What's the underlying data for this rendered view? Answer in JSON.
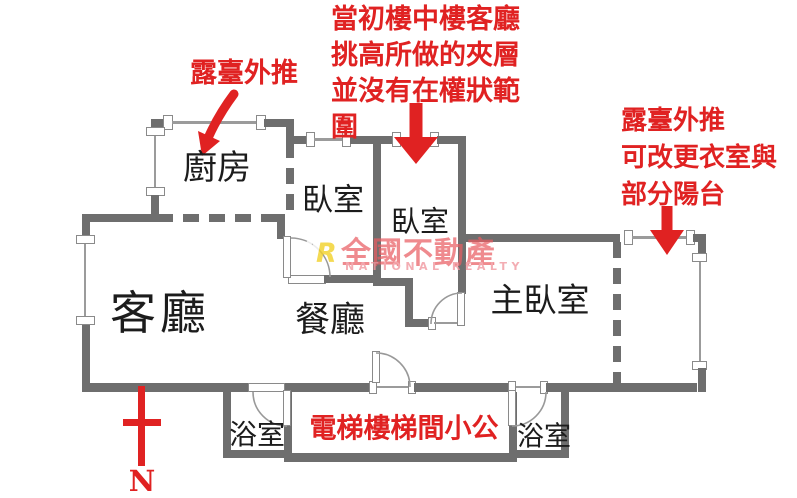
{
  "floorplan": {
    "rooms": {
      "kitchen": "廚房",
      "bedroom1": "臥室",
      "bedroom2": "臥室",
      "living": "客廳",
      "dining": "餐廳",
      "master": "主臥室",
      "bath_left": "浴室",
      "bath_right": "浴室"
    },
    "common_area_label": "電梯樓梯間小公",
    "compass_letter": "N"
  },
  "annotations": {
    "terrace_left": "露臺外推",
    "mezzanine_lines": [
      "當初樓中樓客廳",
      "挑高所做的夾層",
      "並沒有在權狀範",
      "圍"
    ],
    "terrace_right_lines": [
      "露臺外推",
      "可改更衣室與",
      "部分陽台"
    ]
  },
  "watermark": {
    "brand": "全國不動產",
    "brand_en": "NATIONAL REALTY",
    "logo_letter": "R"
  },
  "colors": {
    "annotation_red": "#e02222",
    "wall_gray": "#6e6e6e",
    "window_gray": "#9b9b9b",
    "watermark_pink": "#e85c62",
    "logo_yellow": "#f2d22e"
  }
}
